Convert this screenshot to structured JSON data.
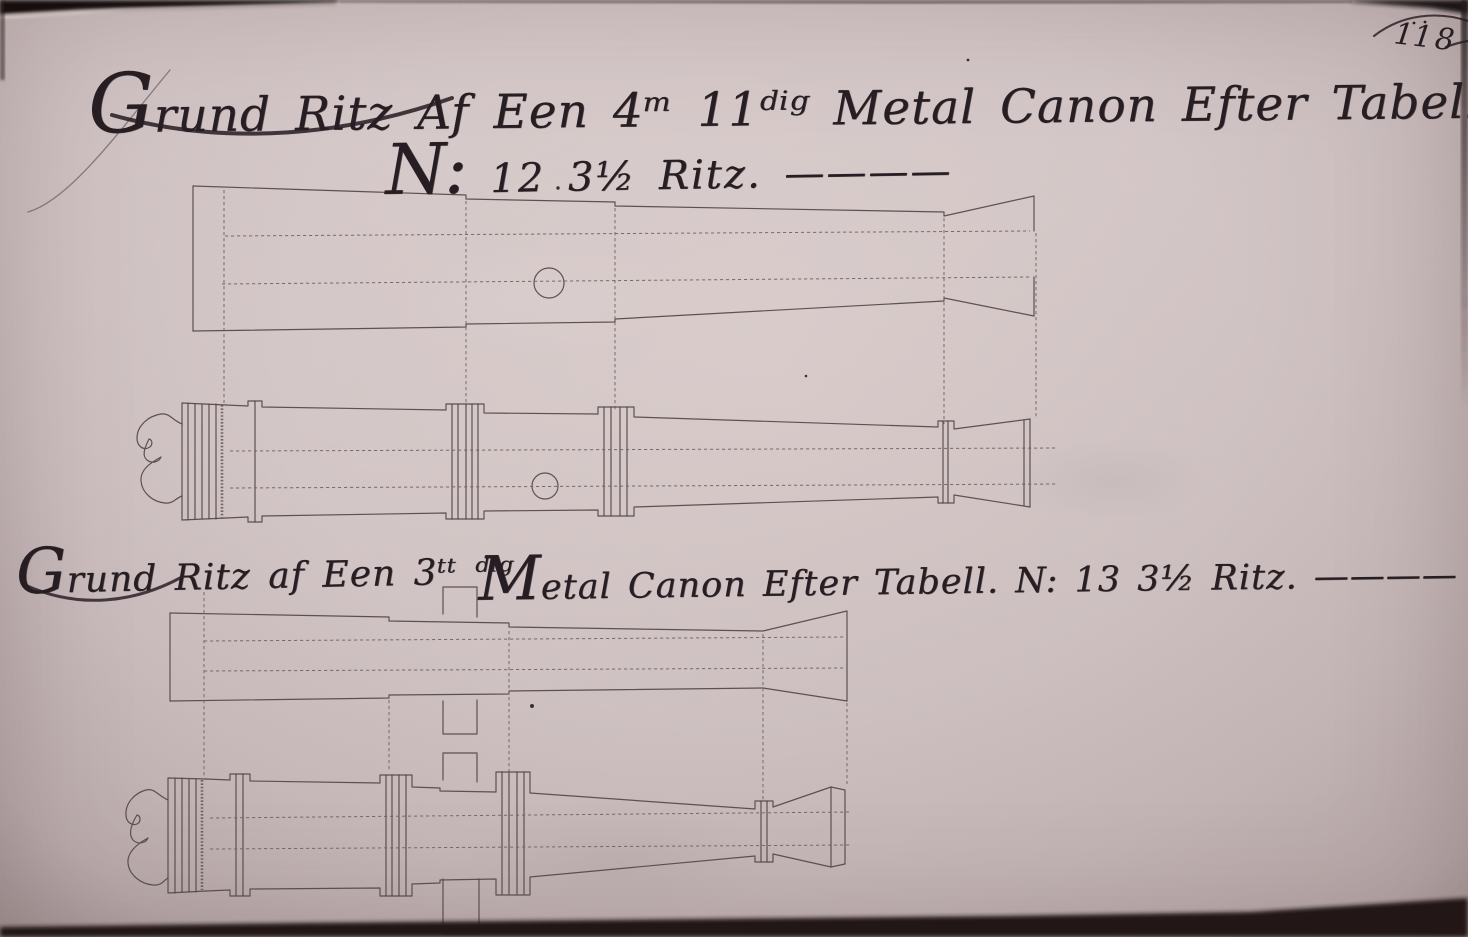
{
  "document": {
    "page_number": "118",
    "header": {
      "title_line_1": "Grund Ritz Af Een 4ᵐ 11ᵈⁱᵍ Metal Canon Efter Tabell",
      "title_line_2": "N: 12 3½ Ritz. ————"
    },
    "section_2": {
      "caption_left": "Grund Ritz af Een 3ᵗᵗ ᵈⁱᵍ",
      "caption_right": "Metal Canon Efter Tabell. N: 13 3½ Ritz. ————"
    },
    "figures": [
      {
        "name": "plan-view-canon-1",
        "kind": "outline plan (top) view of 4ᵐ 11ᵈⁱᵍ metal cannon, table N:12"
      },
      {
        "name": "profile-view-canon-1",
        "kind": "side profile with cascabel, ring mouldings, trunnion circle and muzzle swell"
      },
      {
        "name": "plan-view-canon-2",
        "kind": "outline plan (top) view of 3ᵗᵗ ᵈⁱᵍ metal cannon with trunnion stubs, table N:13"
      },
      {
        "name": "profile-view-canon-2",
        "kind": "side profile with cascabel, ring mouldings and muzzle swell"
      }
    ],
    "colors": {
      "paper": "#d2c5c5",
      "ink_text": "#271e23",
      "ink_drawing": "#53464b",
      "edge_shadow": "#1b1312"
    }
  }
}
